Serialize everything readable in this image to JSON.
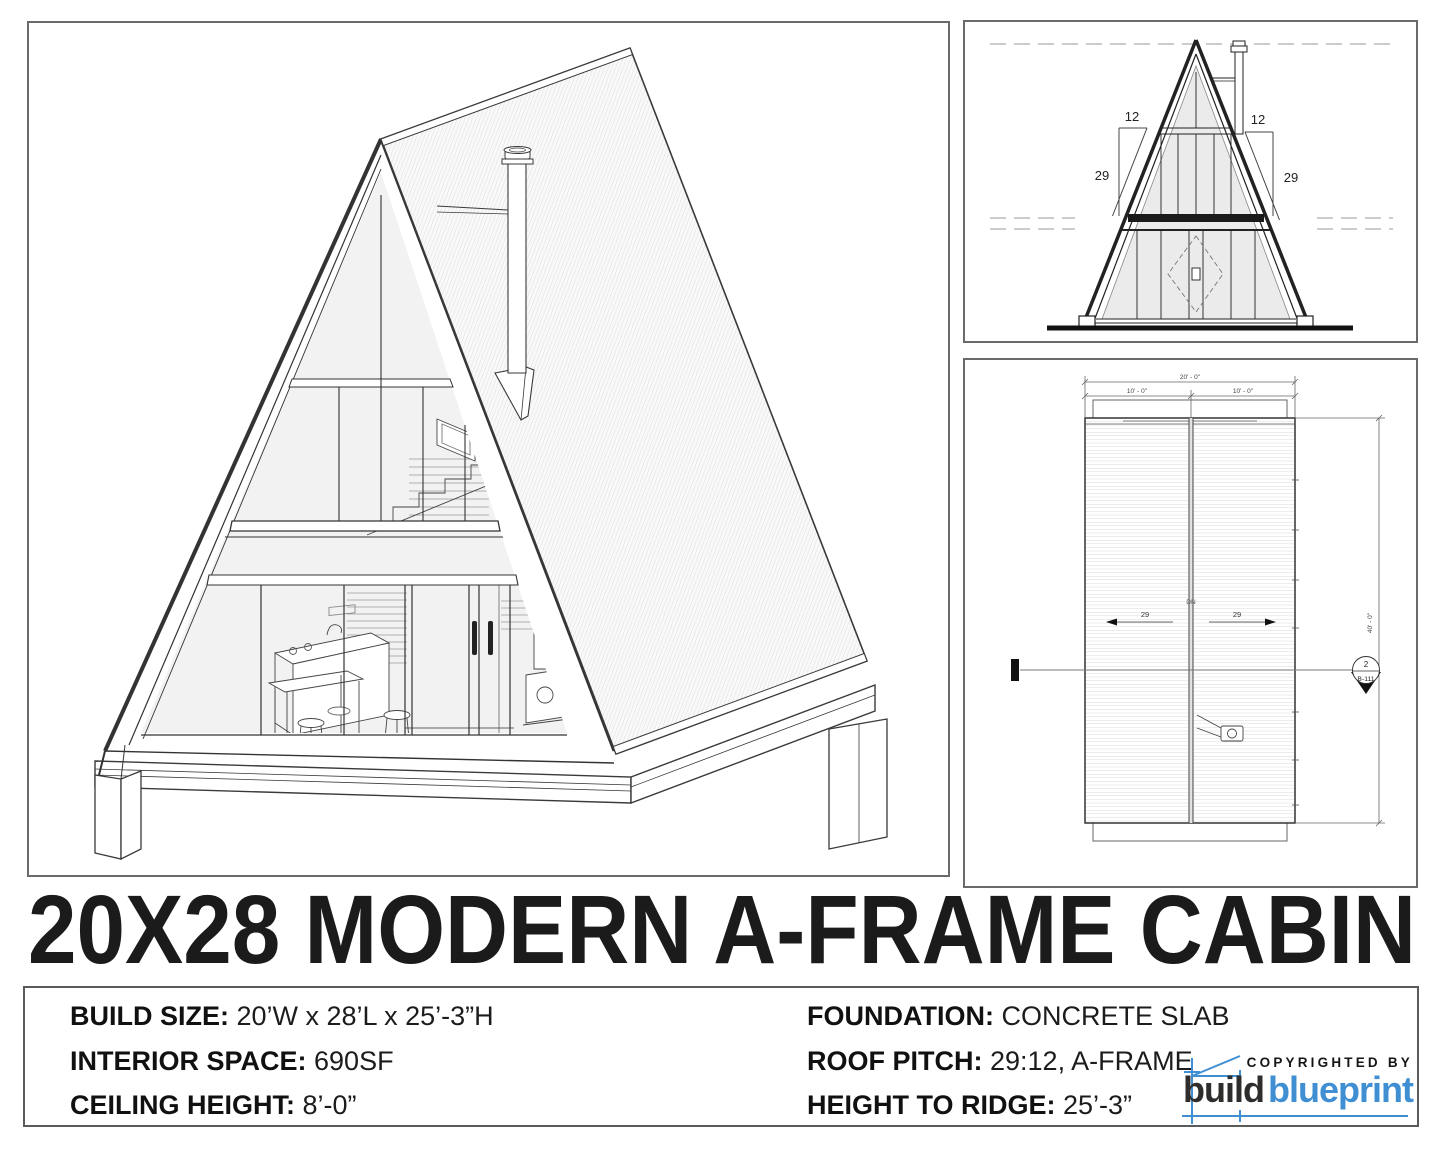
{
  "sheet": {
    "title": "20X28 MODERN A-FRAME CABIN"
  },
  "specs": {
    "left": [
      {
        "label": "BUILD SIZE:",
        "value": " 20’W x 28’L x 25’-3”H"
      },
      {
        "label": "INTERIOR SPACE:",
        "value": " 690SF"
      },
      {
        "label": "CEILING HEIGHT:",
        "value": " 8’-0”"
      }
    ],
    "right": [
      {
        "label": "FOUNDATION:",
        "value": " CONCRETE SLAB"
      },
      {
        "label": "ROOF PITCH:",
        "value": " 29:12, A-FRAME"
      },
      {
        "label": "HEIGHT TO RIDGE:",
        "value": " 25’-3”"
      }
    ]
  },
  "logo": {
    "copyrighted": "COPYRIGHTED BY",
    "brand_dark": "build",
    "brand_blue": "blueprint",
    "accent_blue": "#3f8fd2",
    "ink": "#2e2d2c"
  },
  "elevation": {
    "pitch_run_left": "12",
    "pitch_run_right": "12",
    "pitch_rise_left": "29",
    "pitch_rise_right": "29"
  },
  "plan": {
    "width_total": "20' - 0\"",
    "width_left": "10' - 0\"",
    "width_right": "10' - 0\"",
    "length": "40' - 0\"",
    "slope_left": "29",
    "slope_right": "29",
    "down": "DN",
    "section_detail": "2",
    "section_sheet": "B-111"
  }
}
